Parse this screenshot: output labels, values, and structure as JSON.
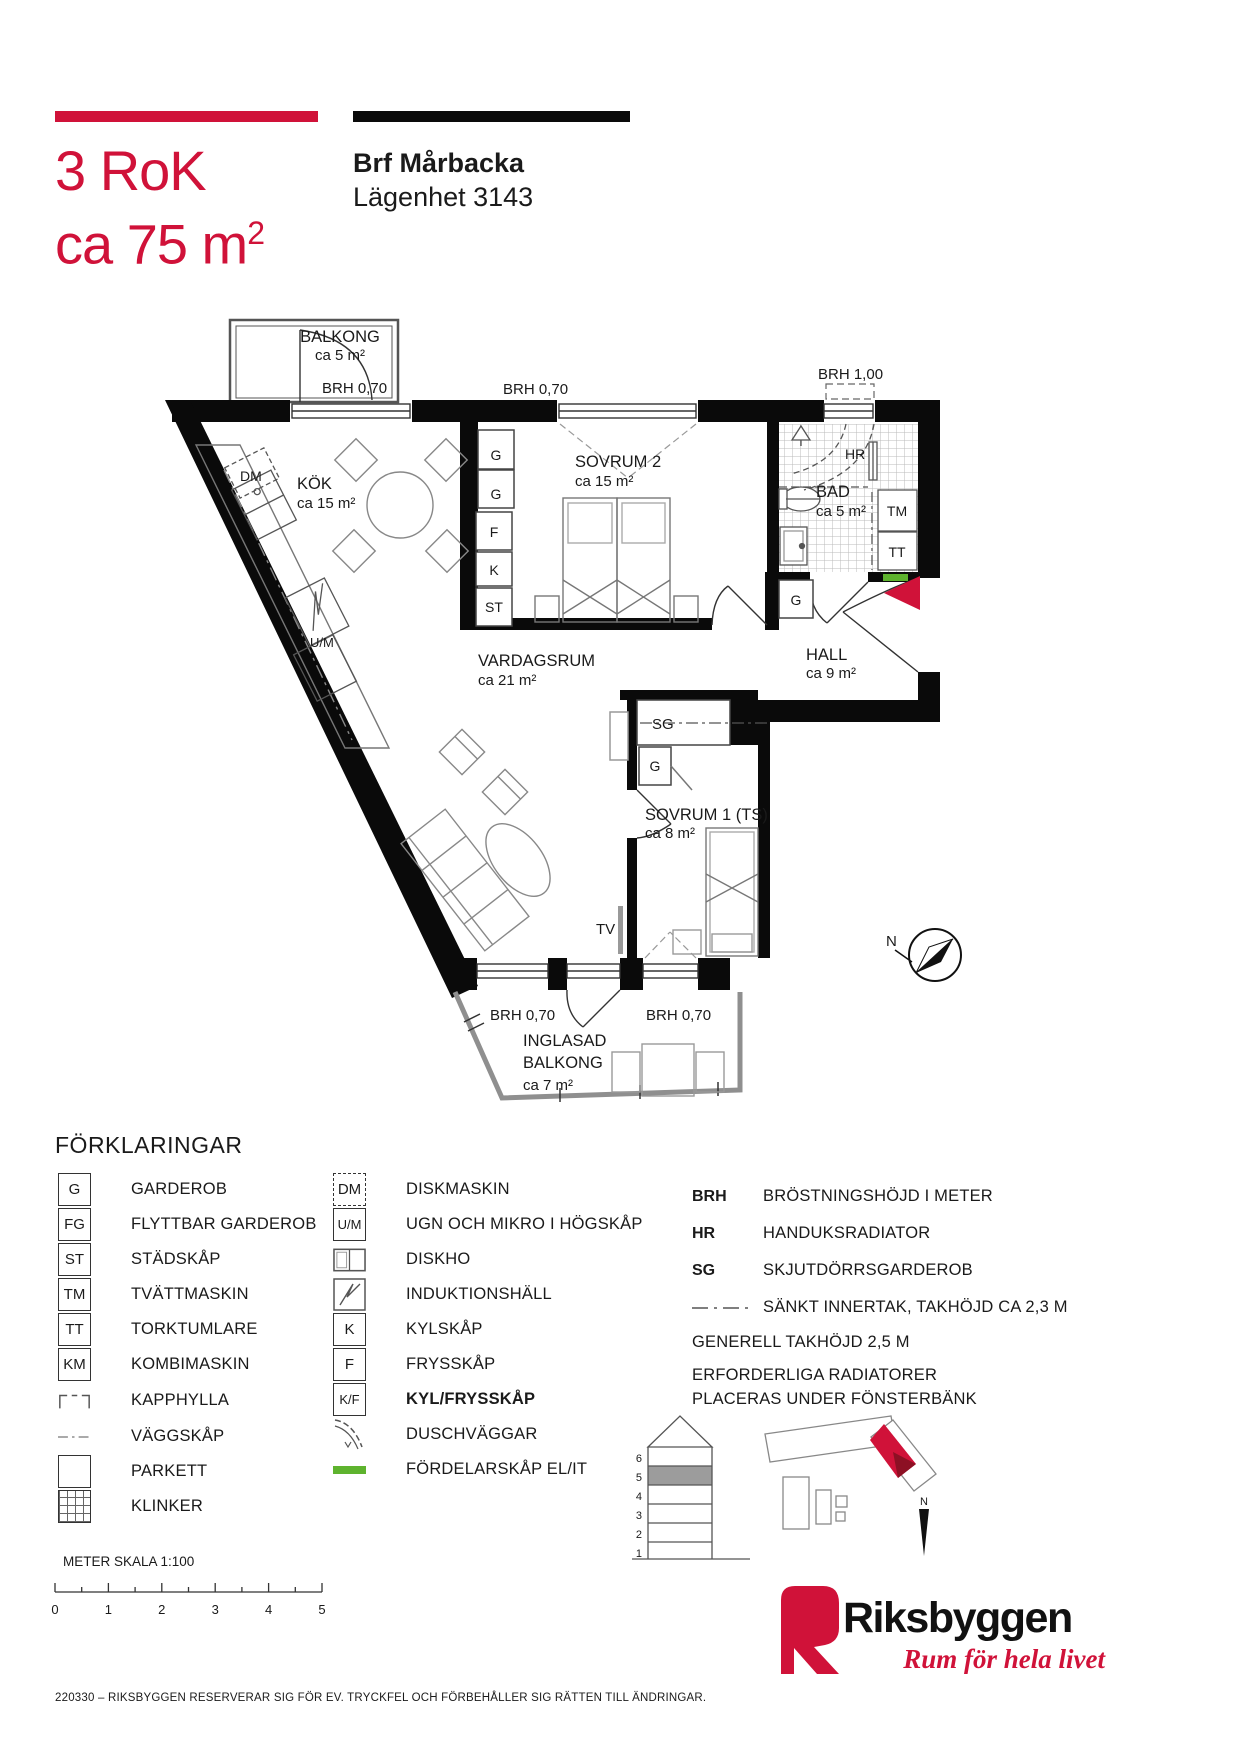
{
  "header": {
    "rooms_line": "3 RoK",
    "area_line": "ca 75 m",
    "area_sup": "2",
    "project_name": "Brf Mårbacka",
    "apartment": "Lägenhet 3143"
  },
  "plan": {
    "balkong": {
      "name": "BALKONG",
      "area": "ca 5 m²",
      "brh": "BRH 0,70"
    },
    "brh_top_center": "BRH 0,70",
    "brh_bad": "BRH 1,00",
    "kok": {
      "name": "KÖK",
      "area": "ca 15 m²",
      "dm": "DM",
      "um": "U/M",
      "g1": "G",
      "g2": "G",
      "f": "F",
      "k": "K",
      "st": "ST"
    },
    "sovrum2": {
      "name": "SOVRUM 2",
      "area": "ca 15 m²"
    },
    "bad": {
      "name": "BAD",
      "area": "ca 5 m²",
      "hr": "HR",
      "tm": "TM",
      "tt": "TT"
    },
    "hall": {
      "name": "HALL",
      "area": "ca 9 m²",
      "g": "G"
    },
    "vardagsrum": {
      "name": "VARDAGSRUM",
      "area": "ca 21 m²",
      "tv": "TV"
    },
    "sovrum1": {
      "name": "SOVRUM 1 (TS)",
      "area": "ca 8 m²",
      "sg": "SG",
      "g": "G"
    },
    "brh_bottom_left": "BRH 0,70",
    "brh_bottom_right": "BRH 0,70",
    "inglasad": {
      "line1": "INGLASAD",
      "line2": "BALKONG",
      "area": "ca 7 m²"
    },
    "compass_n": "N"
  },
  "legend": {
    "title": "FÖRKLARINGAR",
    "col1": [
      {
        "code": "G",
        "label": "GARDEROB"
      },
      {
        "code": "FG",
        "label": "FLYTTBAR GARDEROB"
      },
      {
        "code": "ST",
        "label": "STÄDSKÅP"
      },
      {
        "code": "TM",
        "label": "TVÄTTMASKIN"
      },
      {
        "code": "TT",
        "label": "TORKTUMLARE"
      },
      {
        "code": "KM",
        "label": "KOMBIMASKIN"
      },
      {
        "label": "KAPPHYLLA"
      },
      {
        "label": "VÄGGSKÅP"
      },
      {
        "label": "PARKETT"
      },
      {
        "label": "KLINKER"
      }
    ],
    "col2": [
      {
        "code": "DM",
        "label": "DISKMASKIN"
      },
      {
        "code": "U/M",
        "label": "UGN OCH MIKRO  I HÖGSKÅP"
      },
      {
        "label": "DISKHO"
      },
      {
        "label": "INDUKTIONSHÄLL"
      },
      {
        "code": "K",
        "label": "KYLSKÅP"
      },
      {
        "code": "F",
        "label": "FRYSSKÅP"
      },
      {
        "code": "K/F",
        "label": "KYL/FRYSSKÅP"
      },
      {
        "label": "DUSCHVÄGGAR"
      },
      {
        "label": "FÖRDELARSKÅP EL/IT"
      }
    ],
    "col3": [
      {
        "code": "BRH",
        "label": "BRÖSTNINGSHÖJD I METER"
      },
      {
        "code": "HR",
        "label": "HANDUKSRADIATOR"
      },
      {
        "code": "SG",
        "label": "SKJUTDÖRRSGARDEROB"
      },
      {
        "label": "SÄNKT INNERTAK, TAKHÖJD CA 2,3 M"
      }
    ],
    "notes": [
      "GENERELL TAKHÖJD 2,5 M",
      "ERFORDERLIGA RADIATORER PLACERAS UNDER FÖNSTERBÄNK"
    ]
  },
  "site": {
    "floors": [
      "6",
      "5",
      "4",
      "3",
      "2",
      "1"
    ],
    "north": "N"
  },
  "scalebar": {
    "label": "METER  SKALA 1:100",
    "ticks": [
      "0",
      "1",
      "2",
      "3",
      "4",
      "5"
    ]
  },
  "footer": {
    "disclaimer": "220330 – RIKSBYGGEN RESERVERAR SIG FÖR EV. TRYCKFEL OCH FÖRBEHÅLLER SIG RÄTTEN TILL ÄNDRINGAR."
  },
  "branding": {
    "name": "Riksbyggen",
    "tagline": "Rum för hela livet"
  },
  "colors": {
    "accent_red": "#d01239",
    "distribution_green": "#5eb32e",
    "wall_black": "#0a0a0a"
  }
}
